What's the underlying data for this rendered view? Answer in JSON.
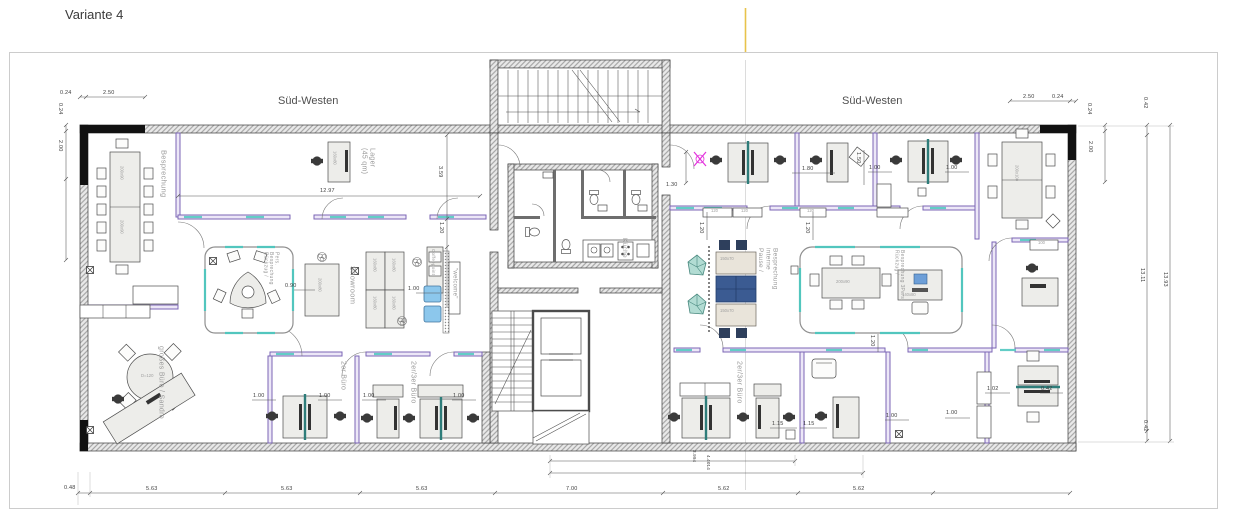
{
  "title": "Variante 4",
  "orientation": {
    "left": "Süd-Westen",
    "right": "Süd-Westen"
  },
  "rooms": {
    "besprechung": "Besprechung",
    "lager": "Lager\n(45 qm)",
    "showroom": "Showroom",
    "rueckzug_links": "Rückzug /\nBesprechung\nPers.",
    "welcome": "\"welcome\"",
    "coffeepoint": "Coffeepoint",
    "kueche": "Küche",
    "grosses_buero": "großes Büro / Sandro",
    "buero_2er": "2er Büro",
    "buero_2er3er_links": "2er/3er Büro",
    "buero_2er3er_rechts": "2er/3er Büro",
    "pause": "Pause /\ninterne\nBesprechung",
    "rueckzug_rechts": "Rückzug /\nBesprechung 3Pers."
  },
  "dims": {
    "tl_a": "0.24",
    "tl_b": "2.50",
    "l_a": "0.24",
    "l_b": "2.00",
    "tr_a": "2.50",
    "tr_b": "0.24",
    "r_a": "0.24",
    "r_b": "2.00",
    "r_c": "0.42",
    "r_d": "13.11",
    "r_e": "13.93",
    "r_f": "0.42",
    "b_a": "0.48",
    "b_b": "5.63",
    "b_c": "5.63",
    "b_d": "5.63",
    "b_e": "7.00",
    "b_f": "5.62",
    "b_g": "5.62",
    "b_h": "3.994",
    "b_i": "4.4014",
    "i_a": "12.97",
    "i_b": "3.59",
    "i_c": "1.20",
    "i_d": "1.30",
    "i_e": "1.20",
    "i_f": "1.20",
    "i_g": "0.90",
    "i_h": "1.00",
    "i_i": "1.00",
    "i_j": "1.00",
    "i_k": "1.00",
    "i_l": "1.00",
    "i_m": "1.00",
    "i_n": "1.00",
    "i_o": "1.80",
    "i_p": "1.50",
    "i_q": "1.15",
    "i_r": "1.15",
    "i_s": "1.02",
    "i_t": "0.42",
    "i_u": "1.00",
    "i_v": "1.00",
    "i_w": "1.20"
  },
  "furniture": {
    "conf_a": "200x90",
    "conf_b": "200x90",
    "show_side": "200x80",
    "show_a": "160x80",
    "show_b": "160x80",
    "show_c": "160x80",
    "show_d": "160x80",
    "lager_desk": "160x80",
    "round": "D=120",
    "pause_a": "150x70",
    "pause_b": "150x70",
    "rz_table": "200x90",
    "rz_desk": "140x80",
    "corner": "200x100",
    "cab_a": "120",
    "cab_b": "120",
    "cab_c": "120",
    "cab_d": "100"
  },
  "colors": {
    "wall_purple": "#7b66b5",
    "glass_teal": "#52c6be",
    "divider_teal": "#2e7d7a",
    "sofa_blue": "#3b5b92",
    "chair_blue": "#8cc7ec",
    "section_yellow": "#e8c34b",
    "marker_magenta": "#e230dc"
  }
}
